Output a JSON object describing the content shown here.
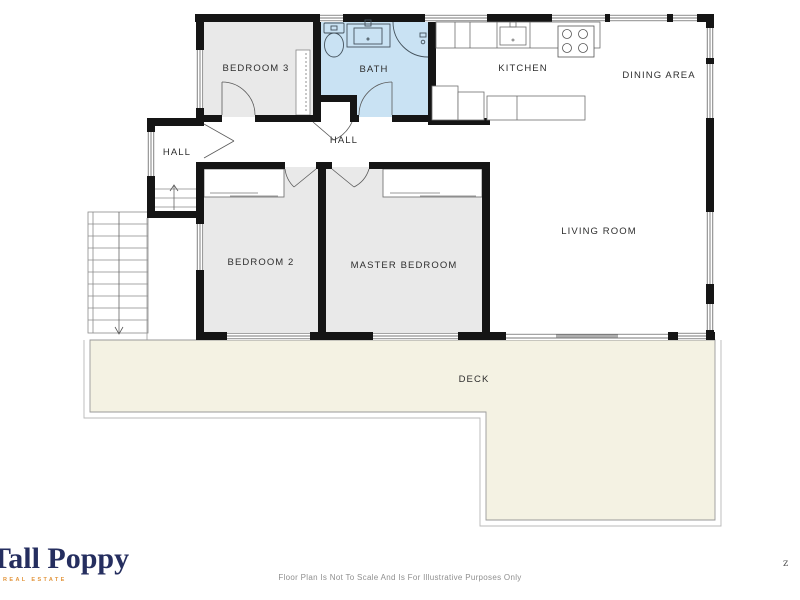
{
  "plan": {
    "rooms": [
      {
        "id": "bedroom-3",
        "label": "BEDROOM 3"
      },
      {
        "id": "bath",
        "label": "BATH"
      },
      {
        "id": "kitchen",
        "label": "KITCHEN"
      },
      {
        "id": "dining-area",
        "label": "DINING AREA"
      },
      {
        "id": "hall-entry",
        "label": "HALL"
      },
      {
        "id": "hall-corridor",
        "label": "HALL"
      },
      {
        "id": "bedroom-2",
        "label": "BEDROOM 2"
      },
      {
        "id": "master-bedroom",
        "label": "MASTER BEDROOM"
      },
      {
        "id": "living-room",
        "label": "LIVING ROOM"
      },
      {
        "id": "deck",
        "label": "DECK"
      }
    ],
    "colors": {
      "wall": "#151515",
      "room_gray": "#e9e9e9",
      "bath_blue": "#c9e2f3",
      "deck_cream": "#f4f2e3"
    }
  },
  "branding": {
    "logo_text": "Tall Poppy",
    "logo_tagline": "REAL ESTATE",
    "logo_color": "#252e5f",
    "tagline_color": "#e2953c"
  },
  "footer": {
    "disclaimer": "Floor Plan Is Not To Scale And Is For Illustrative Purposes Only"
  },
  "watermark": "z"
}
